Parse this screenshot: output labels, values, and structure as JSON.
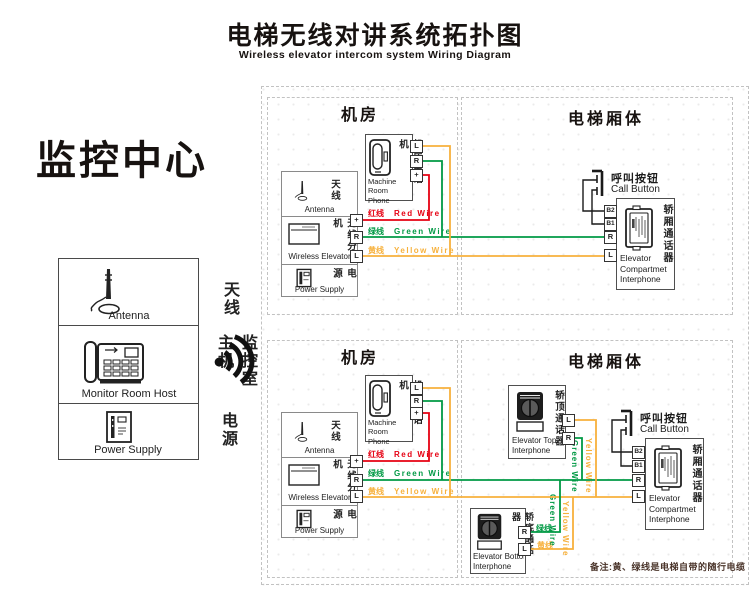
{
  "header": {
    "title": "电梯无线对讲系统拓扑图",
    "subtitle": "Wireless elevator intercom system Wiring Diagram"
  },
  "monitor_center": {
    "title": "监控中心",
    "antenna_zh": "天线",
    "antenna_en": "Antenna",
    "host_zh": "监控室主机",
    "host_en": "Monitor Room Host",
    "power_zh": "电源",
    "power_en": "Power Supply"
  },
  "section_titles": {
    "machine_room": "机房",
    "car_body": "电梯厢体"
  },
  "machine_room_phone": {
    "zh": "机房电话机",
    "en1": "Machine",
    "en2": "Room Phone"
  },
  "wireless_unit": {
    "antenna_zh": "天线",
    "antenna_en": "Antenna",
    "zh": "无线分机",
    "en": "Wireless Elevator",
    "power_zh": "电源",
    "power_en": "Power Supply"
  },
  "wires": {
    "red_zh": "红线",
    "red_en": "Red Wire",
    "green_zh": "绿线",
    "green_en": "Green Wire",
    "yellow_zh": "黄线",
    "yellow_en": "Yellow Wire",
    "green_vertical": "Green Wire",
    "yellow_vertical": "Yellow Wire",
    "green_zh_only": "绿线",
    "yellow_zh_only": "黄线"
  },
  "call_button": {
    "zh": "呼叫按钮",
    "en": "Call Button"
  },
  "compartment_interphone": {
    "zh": "轿厢通话器",
    "en1": "Elevator",
    "en2": "Compartmet",
    "en3": "Interphone"
  },
  "top_interphone": {
    "zh": "轿顶通话器",
    "en1": "Elevator Top",
    "en2": "Interphone"
  },
  "bottom_interphone": {
    "zh": "轿底通话器",
    "en1": "Elevator Bottom",
    "en2": "Interphone"
  },
  "terminals": {
    "l": "L",
    "r": "R",
    "plus": "+",
    "b1": "B1",
    "b2": "B2"
  },
  "note": "备注:黄、绿线是电梯自带的随行电缆",
  "colors": {
    "red": "#e60012",
    "green": "#009944",
    "yellow": "#f7b13c",
    "wire_black": "#1a1a1a",
    "note": "#4a342a"
  }
}
